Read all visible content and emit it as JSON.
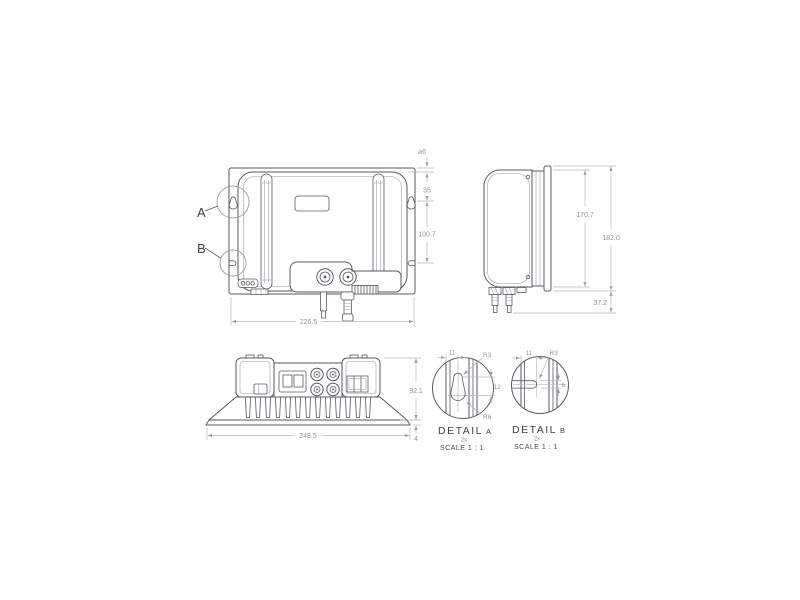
{
  "views": {
    "front": {
      "label_a": "A",
      "label_b": "B",
      "dim_width": "226.5",
      "dim_hole": "⌀6",
      "dim_top_to_hole": "35",
      "dim_hole_to_slot": "100.7"
    },
    "side": {
      "dim_body_height": "170.7",
      "dim_total_height": "182.0",
      "dim_connector": "37.2"
    },
    "bottom": {
      "dim_width": "248.5",
      "dim_depth": "92.1",
      "dim_flange": "4"
    },
    "detail_a": {
      "title": "DETAIL",
      "suffix": "A",
      "count": "2x",
      "scale": "SCALE 1 : 1",
      "dim_edge": "11",
      "dim_r_small": "R3",
      "dim_length": "12",
      "dim_r_large": "R6"
    },
    "detail_b": {
      "title": "DETAIL",
      "suffix": "B",
      "count": "2x",
      "scale": "SCALE 1 : 1",
      "dim_edge": "11",
      "dim_r": "R3",
      "dim_height": "6"
    }
  }
}
